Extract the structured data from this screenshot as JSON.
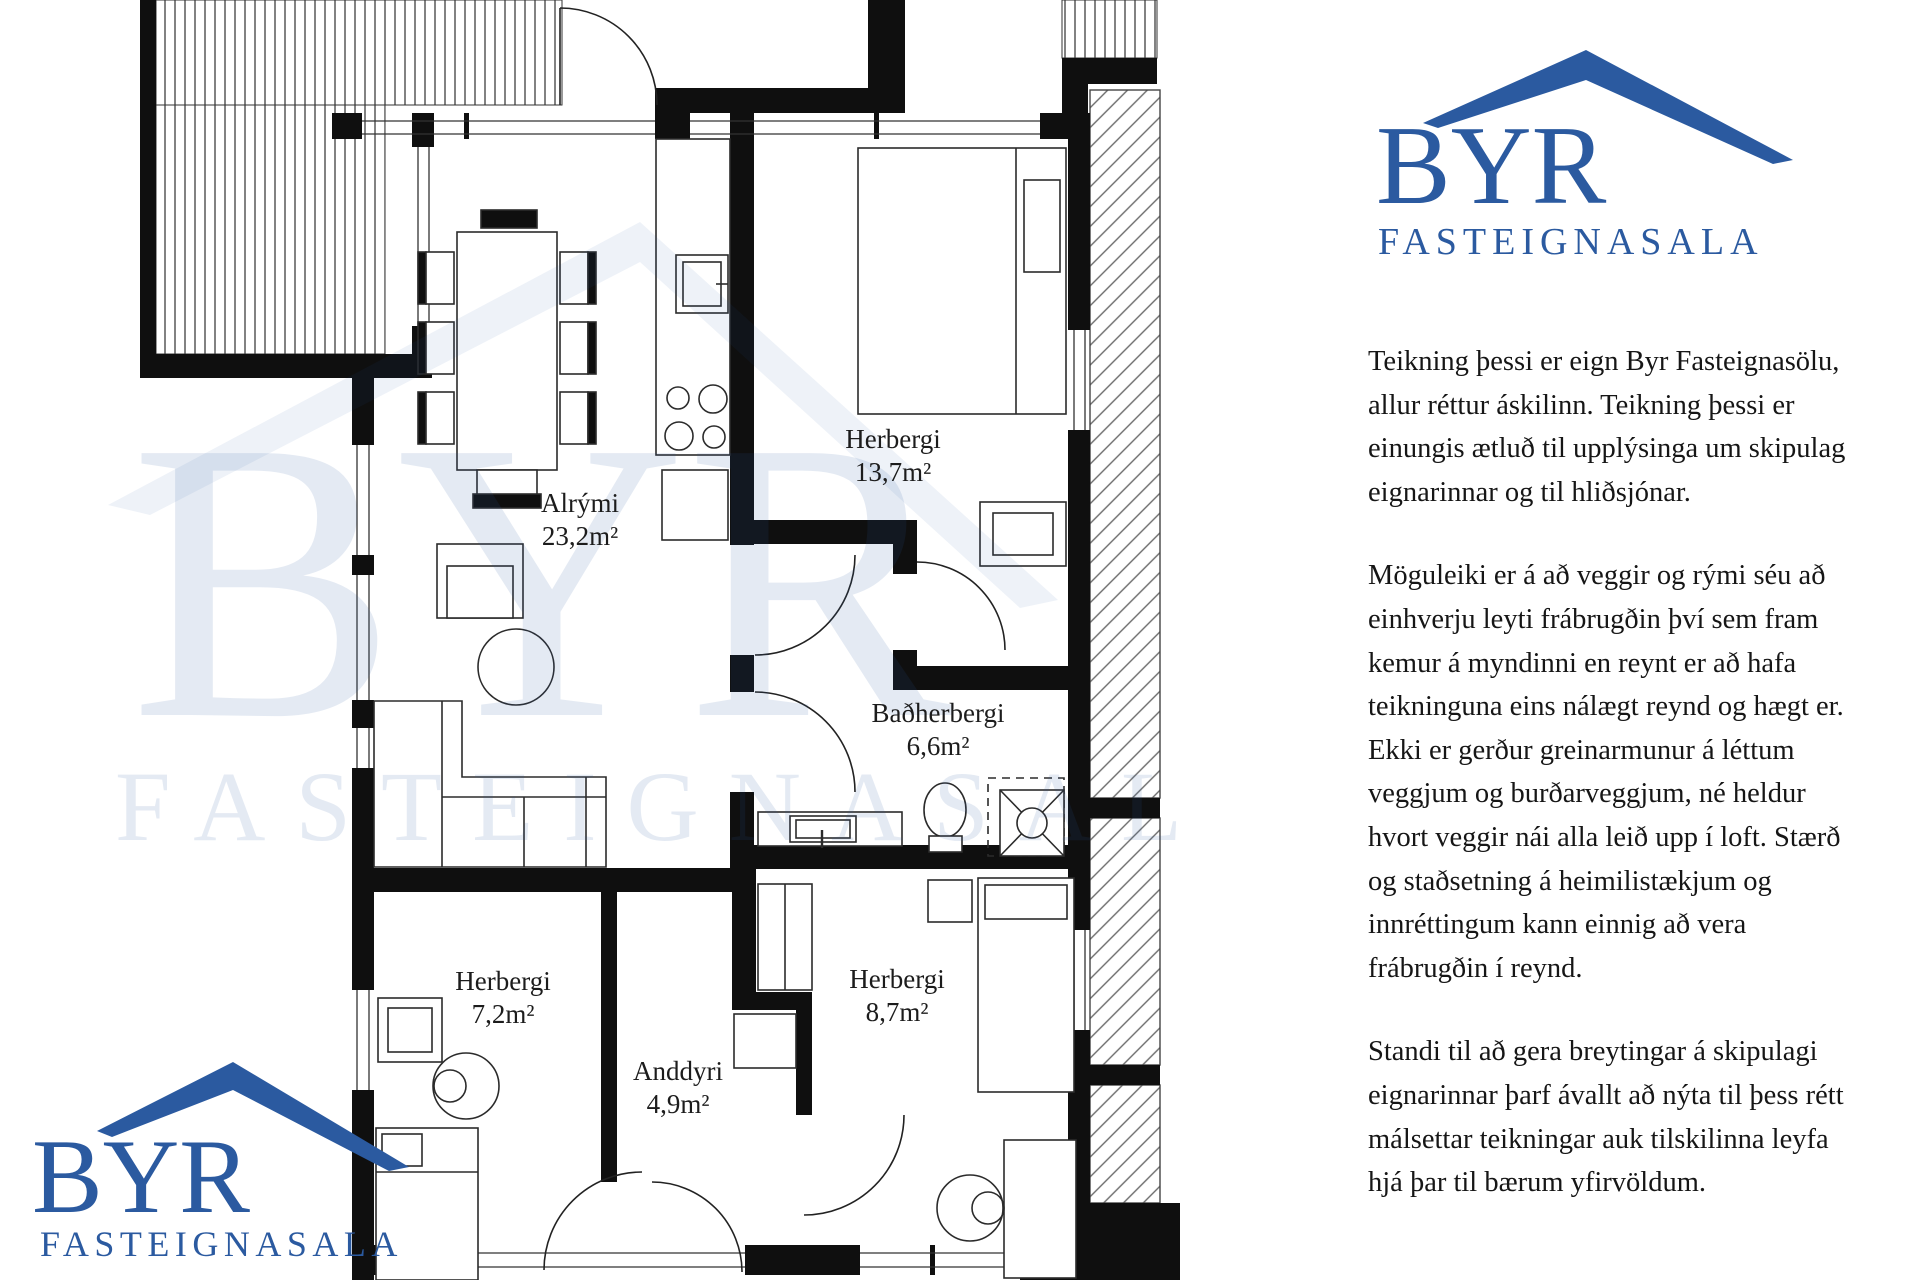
{
  "logo": {
    "title": "BYR",
    "subtitle": "FASTEIGNASALA",
    "accent_color": "#2b5aa0"
  },
  "plan": {
    "rooms": [
      {
        "name": "Alrými",
        "area": "23,2m²"
      },
      {
        "name": "Herbergi",
        "area": "13,7m²"
      },
      {
        "name": "Baðherbergi",
        "area": "6,6m²"
      },
      {
        "name": "Herbergi",
        "area": "7,2m²"
      },
      {
        "name": "Anddyri",
        "area": "4,9m²"
      },
      {
        "name": "Herbergi",
        "area": "8,7m²"
      }
    ]
  },
  "notes": {
    "paragraphs": [
      "Teikning þessi er eign Byr Fasteignasölu, allur réttur áskilinn. Teikning þessi er einungis ætluð til upplýsinga um skipulag eignarinnar og til hliðsjónar.",
      "Möguleiki er á að veggir og rými séu að einhverju leyti frábrugðin því sem fram kemur á myndinni en reynt er að hafa teikninguna eins nálægt reynd og hægt er. Ekki er gerður greinarmunur á léttum veggjum og burðarveggjum, né heldur hvort veggir nái alla leið upp í loft. Stærð og staðsetning á heimilistækjum og innréttingum kann einnig að vera frábrugðin í reynd.",
      "Standi til að gera breytingar á skipulagi eignarinnar þarf ávallt að nýta til þess rétt málsettar teikningar auk tilskilinna leyfa hjá þar til bærum yfirvöldum."
    ]
  }
}
